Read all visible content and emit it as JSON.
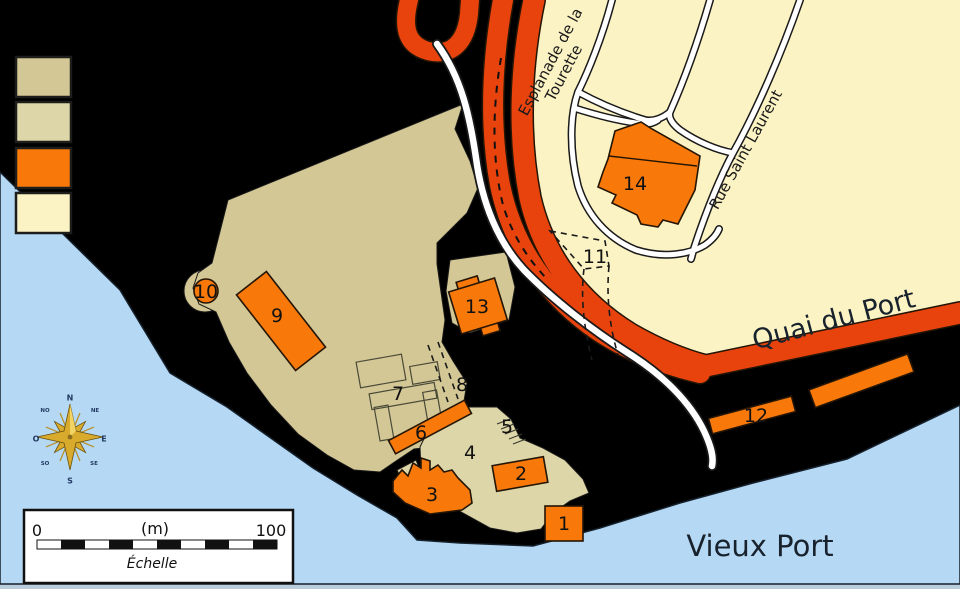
{
  "map": {
    "markers": [
      {
        "label": "1"
      },
      {
        "label": "2"
      },
      {
        "label": "3"
      },
      {
        "label": "4"
      },
      {
        "label": "5"
      },
      {
        "label": "6"
      },
      {
        "label": "7"
      },
      {
        "label": "8"
      },
      {
        "label": "9"
      },
      {
        "label": "10"
      },
      {
        "label": "11"
      },
      {
        "label": "12"
      },
      {
        "label": "13"
      },
      {
        "label": "14"
      }
    ],
    "streets": {
      "esplanade_line1": "Esplanade de la",
      "esplanade_line2": "Tourette",
      "rue_saint_laurent": "Rue Saint Laurent",
      "quai_du_port": "Quai du Port"
    },
    "water_label": "Vieux Port"
  },
  "legend": {
    "swatches": [
      {
        "name": "fort-grounds-tan",
        "color": "#d3c795"
      },
      {
        "name": "fort-terrace-light-tan",
        "color": "#ddd6a8"
      },
      {
        "name": "building-orange",
        "color": "#f8790a"
      },
      {
        "name": "city-cream",
        "color": "#fbf3c4"
      }
    ]
  },
  "compass": {
    "n": "N",
    "ne": "NE",
    "e": "E",
    "se": "SE",
    "s": "S",
    "so": "SO",
    "o": "O",
    "no": "NO"
  },
  "scale_bar": {
    "start": "0",
    "unit": "(m)",
    "end": "100",
    "caption": "Échelle"
  },
  "colors": {
    "background": "#000000",
    "water": "#b5d8f4",
    "road_orange": "#e8430d",
    "building_orange": "#f8790a",
    "fort_tan": "#d3c795",
    "fort_light_tan": "#ddd6a8",
    "city_cream": "#fbf3c4"
  }
}
